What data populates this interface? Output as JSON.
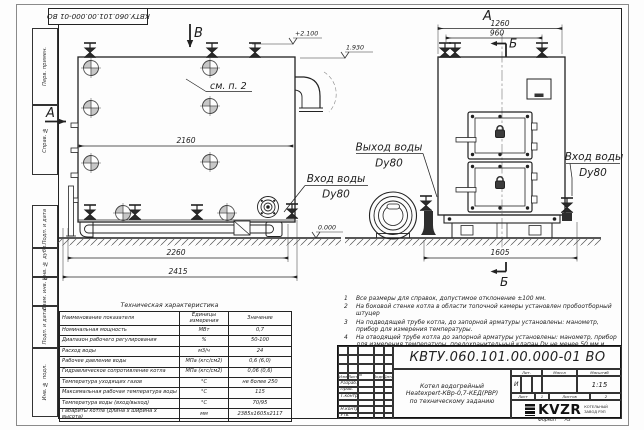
{
  "colors": {
    "line": "#222222",
    "paper": "#fdfdfd"
  },
  "stamp_top": "КВТУ.060.101.00.000-01  ВО",
  "margin_boxes": [
    "Перв. примен.",
    "Справ. №",
    "Подп. и дата",
    "Инв. № дубл.",
    "Взам. инв. №",
    "Подп. и дата",
    "Инв. № подл."
  ],
  "views": {
    "side_view": {
      "section_b": "В",
      "section_a": "А",
      "note_ref": "см. п. 2",
      "levels": {
        "top": "+2.100",
        "mid": "1.930",
        "zero": "0.000"
      },
      "dims": {
        "width": "2160",
        "base": "2260",
        "overall": "2415"
      },
      "inlet_line1": "Вход воды",
      "inlet_line2": "Dy80",
      "outlet_line1": "Выход воды",
      "outlet_line2": "Dy80"
    },
    "front_view": {
      "view_label": "А",
      "section_b": "Б",
      "dims": {
        "top": "1260",
        "nozzles": "960",
        "base": "1605"
      },
      "inlet_line1": "Вход воды",
      "inlet_line2": "Dy80"
    }
  },
  "notes": [
    {
      "num": "1",
      "text": "Все размеры для справок, допустимое отклонение ±100 мм."
    },
    {
      "num": "2",
      "text": "На боковой стенке котла в области топочной камеры установлен пробоотборный штуцер"
    },
    {
      "num": "3",
      "text": "На  подводящей трубе котла, до запорной арматуры установлены: манометр, прибор для измерения температуры."
    },
    {
      "num": "4",
      "text": "На отводящей трубе котла до запорной арматуры установлены: манометр, прибор для измерения температуры, предохранительный клапан Dy не менее 50 мм и обвод с обратным клапаном Dy не менее 50 мм."
    }
  ],
  "tech_table": {
    "title": "Техническая характеристика",
    "headers": [
      "Наименование показателя",
      "Единицы измерения",
      "Значение"
    ],
    "rows": [
      [
        "Номинальная мощность",
        "МВт",
        "0,7"
      ],
      [
        "Диапазон рабочего регулирования",
        "%",
        "50-100"
      ],
      [
        "Расход воды",
        "м3/ч",
        "24"
      ],
      [
        "Рабочее давление воды",
        "МПа (кгс/см2)",
        "0,6 (6,0)"
      ],
      [
        "Гидравлическое сопротивление котла",
        "МПа (кгс/см2)",
        "0,06 (0,6)"
      ],
      [
        "Температура уходящих газов",
        "°С",
        "не более 250"
      ],
      [
        "Максимальная рабочая температура воды",
        "°С",
        "115"
      ],
      [
        "Температура воды (вход/выход)",
        "°С",
        "70/95"
      ],
      [
        "Габариты котла (длина х ширина х высота)",
        "мм",
        "2385х1605х2117"
      ]
    ]
  },
  "title_block": {
    "doc_number": "КВТУ.060.101.00.000-01  ВО",
    "sig_header": [
      "Изм",
      "Лист",
      "N докум.",
      "Подп.",
      "Дата"
    ],
    "sig_rows": [
      "Разраб.",
      "Пров.",
      "Т.контр.",
      "",
      "Н.контр.",
      "Утв."
    ],
    "name_line1": "Котел водогрейный",
    "name_line2": "Heatexpert-КВр-0,7-КЕД(РВР)",
    "name_line3": "по техническому заданию",
    "lit_header": [
      "Лит.",
      "Масса",
      "Масштаб"
    ],
    "lit_value": "И",
    "scale_value": "1:15",
    "sheet_label": "Лист",
    "sheet_value": "1",
    "sheets_label": "Листов",
    "sheets_value": "2",
    "logo_text": "KVZR",
    "company_line1": "КОТЕЛЬНЫЙ",
    "company_line2": "ЗАВОД РЭП",
    "format_label": "Формат",
    "format_value": "А3"
  }
}
